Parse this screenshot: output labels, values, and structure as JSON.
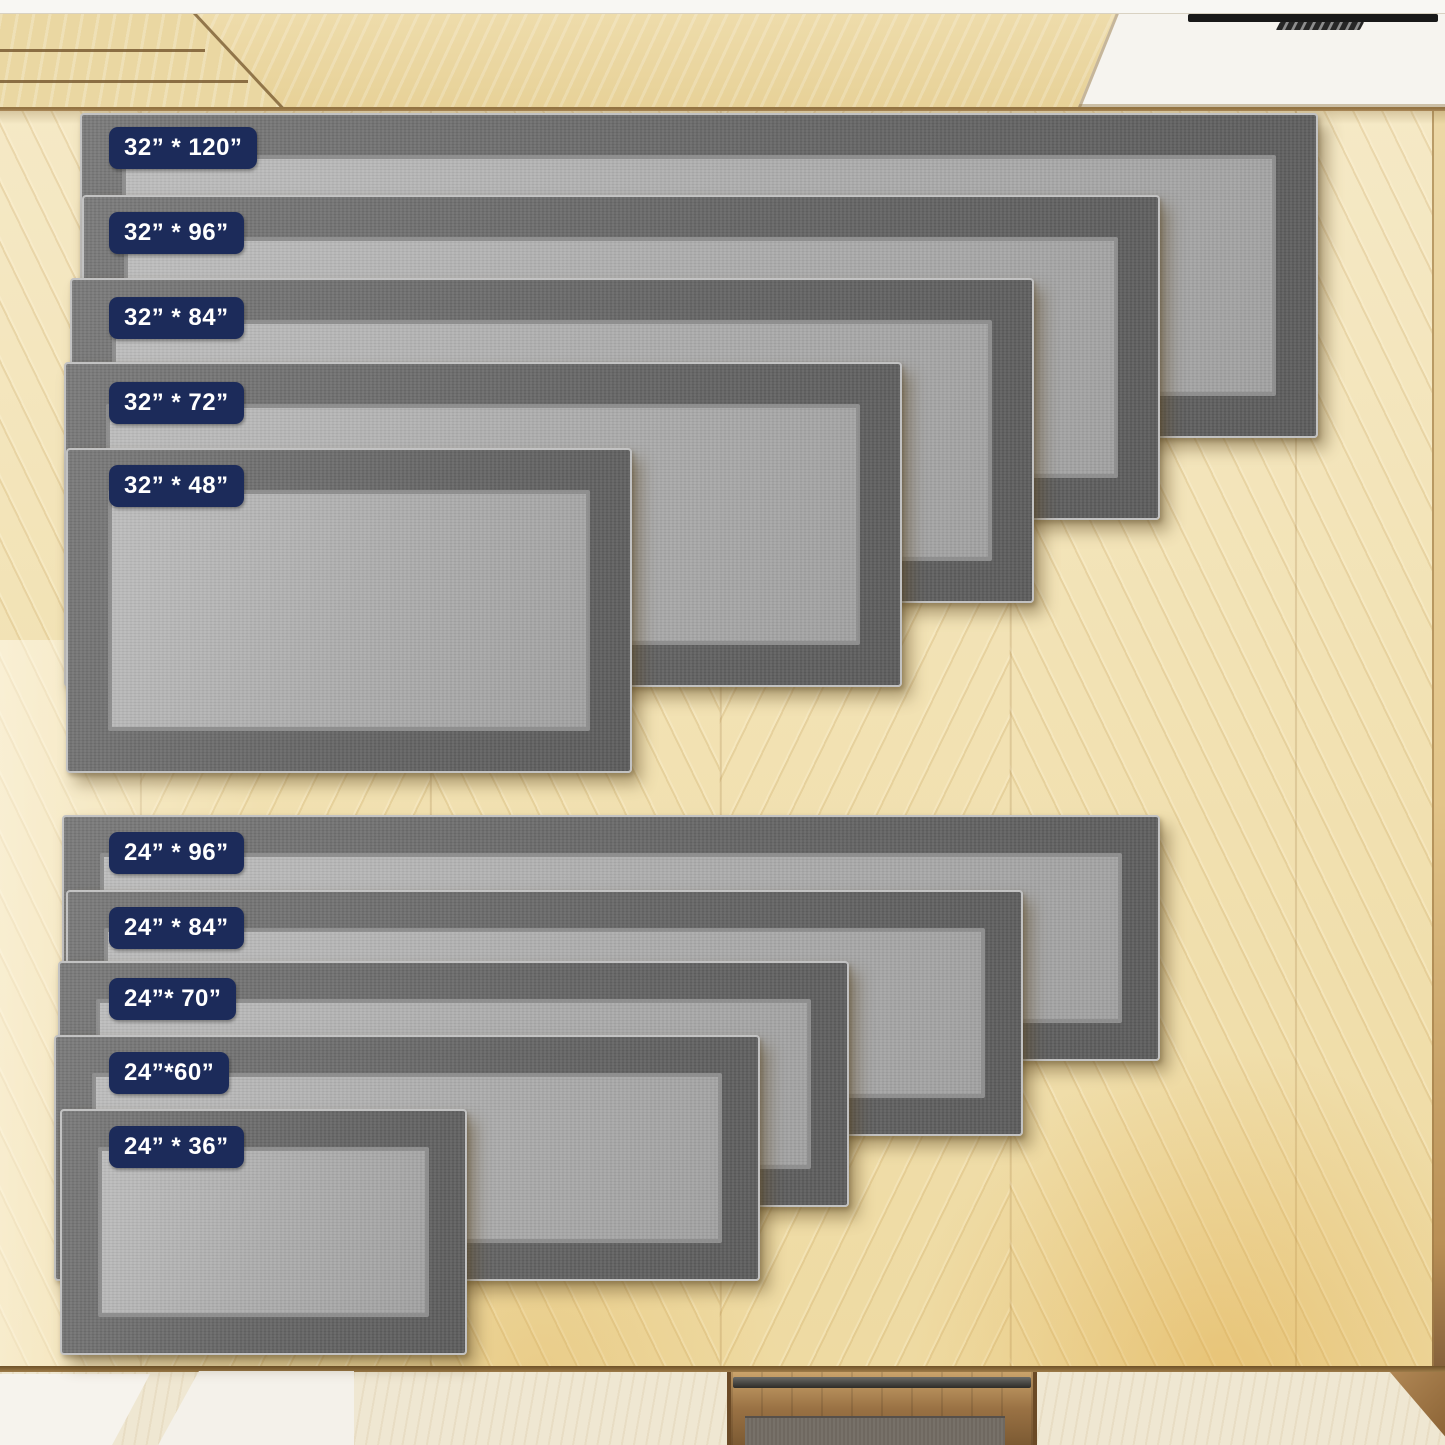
{
  "image_type": "product-size-comparison-photo",
  "badge": {
    "x": 107,
    "bg": "#1c2b5a",
    "text_color": "#ffffff"
  },
  "colors": {
    "rug_border": "#676767",
    "rug_field": "#ababab",
    "rug_binding": "#c2c2c2",
    "floor_base": "#f2e2b4",
    "floor_gold": "#dea43a",
    "cabinet_wood": "#ecd9a6",
    "white_panel": "#f6f4ef",
    "vent_slot": "#191919",
    "platform": "#efe7d2",
    "white_slab": "#f5f2ec",
    "pit_wood": "#9a7244",
    "pit_mat": "#6f6860",
    "seam": "#8a6a3c",
    "badge_navy": "#1c2b5a"
  },
  "rug_groups": [
    {
      "name": "32-inch-wide-runners",
      "border_px": 42,
      "rugs": [
        {
          "id": "rug-32x120",
          "label": "32” * 120”",
          "left": 80,
          "top": 113,
          "width": 1238,
          "height": 325,
          "badge_top": 125
        },
        {
          "id": "rug-32x96",
          "label": "32” * 96”",
          "left": 82,
          "top": 195,
          "width": 1078,
          "height": 325,
          "badge_top": 210
        },
        {
          "id": "rug-32x84",
          "label": "32” * 84”",
          "left": 70,
          "top": 278,
          "width": 964,
          "height": 325,
          "badge_top": 295
        },
        {
          "id": "rug-32x72",
          "label": "32” * 72”",
          "left": 64,
          "top": 362,
          "width": 838,
          "height": 325,
          "badge_top": 380
        },
        {
          "id": "rug-32x48",
          "label": "32” * 48”",
          "left": 66,
          "top": 448,
          "width": 566,
          "height": 325,
          "badge_top": 463
        }
      ]
    },
    {
      "name": "24-inch-wide-runners",
      "border_px": 38,
      "rugs": [
        {
          "id": "rug-24x96",
          "label": "24” * 96”",
          "left": 62,
          "top": 815,
          "width": 1098,
          "height": 246,
          "badge_top": 830
        },
        {
          "id": "rug-24x84",
          "label": "24” * 84”",
          "left": 66,
          "top": 890,
          "width": 957,
          "height": 246,
          "badge_top": 905
        },
        {
          "id": "rug-24x70",
          "label": "24”* 70”",
          "left": 58,
          "top": 961,
          "width": 791,
          "height": 246,
          "badge_top": 976
        },
        {
          "id": "rug-24x60",
          "label": "24”*60”",
          "left": 54,
          "top": 1035,
          "width": 706,
          "height": 246,
          "badge_top": 1050
        },
        {
          "id": "rug-24x36",
          "label": "24” * 36”",
          "left": 60,
          "top": 1109,
          "width": 407,
          "height": 246,
          "badge_top": 1124
        }
      ]
    }
  ]
}
